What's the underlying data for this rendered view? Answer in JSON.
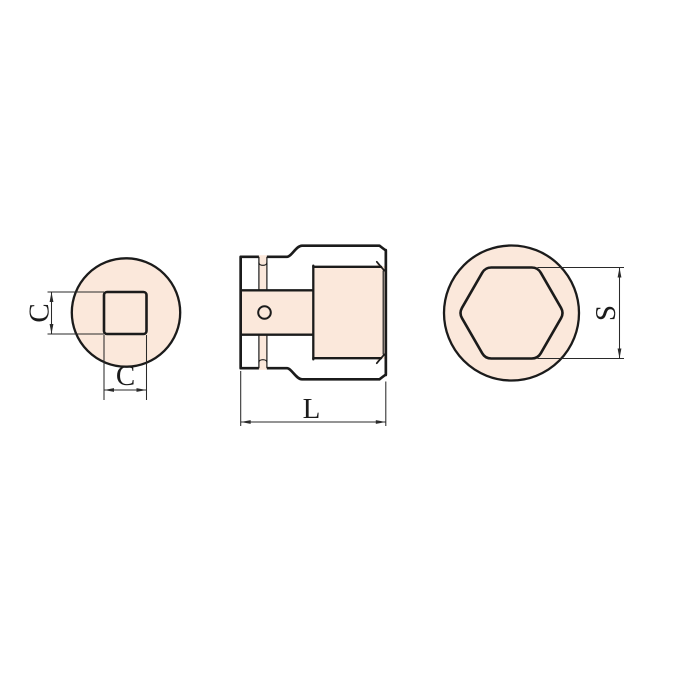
{
  "drawing": {
    "labels": {
      "c_vertical": "C",
      "c_horizontal": "C",
      "length": "L",
      "across_flats": "S"
    },
    "colors": {
      "fill": "#FBE8DB",
      "outline": "#1B1B1B",
      "dimension": "#2A2A2A",
      "background": "#FFFFFF"
    }
  }
}
